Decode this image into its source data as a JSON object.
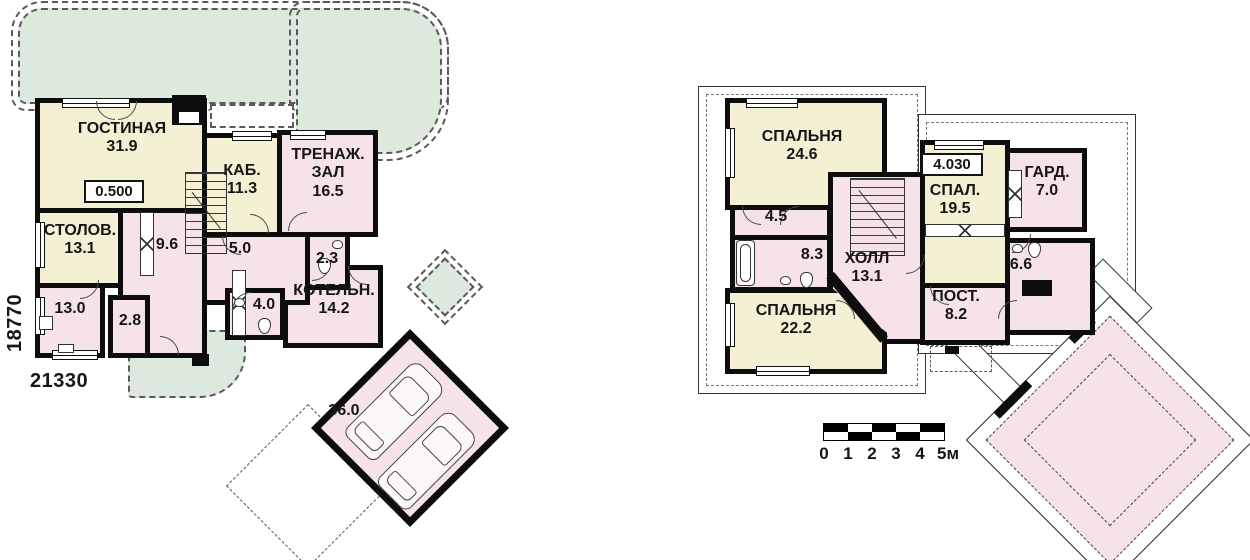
{
  "document": {
    "type": "house floor plans",
    "language": "ru"
  },
  "colors": {
    "room_yellow": "#F4F0D3",
    "room_pink": "#F5E3E9",
    "terrace_green": "#DEE9DE",
    "wall": "#0D0D0D"
  },
  "floor1": {
    "elevation": "0.500",
    "dim_width": "21330",
    "dim_height": "18770",
    "rooms": [
      {
        "name": "ГОСТИНАЯ",
        "area": "31.9"
      },
      {
        "name": "СТОЛОВ.",
        "area": "13.1"
      },
      {
        "name": "",
        "area": "9.6"
      },
      {
        "name": "КАБ.",
        "area": "11.3"
      },
      {
        "name": "ТРЕНАЖ. ЗАЛ",
        "area": "16.5"
      },
      {
        "name": "",
        "area": "5.0"
      },
      {
        "name": "",
        "area": "2.3"
      },
      {
        "name": "",
        "area": "13.0"
      },
      {
        "name": "",
        "area": "2.8"
      },
      {
        "name": "",
        "area": "4.0"
      },
      {
        "name": "КОТЕЛЬН.",
        "area": "14.2"
      },
      {
        "name": "",
        "area": "36.0"
      }
    ]
  },
  "floor2": {
    "elevation": "4.030",
    "rooms": [
      {
        "name": "СПАЛЬНЯ",
        "area": "24.6"
      },
      {
        "name": "",
        "area": "4.5"
      },
      {
        "name": "",
        "area": "8.3"
      },
      {
        "name": "ХОЛЛ",
        "area": "13.1"
      },
      {
        "name": "СПАЛЬНЯ",
        "area": "22.2"
      },
      {
        "name": "СПАЛ.",
        "area": "19.5"
      },
      {
        "name": "ГАРД.",
        "area": "7.0"
      },
      {
        "name": "",
        "area": "6.6"
      },
      {
        "name": "ПОСТ.",
        "area": "8.2"
      }
    ]
  },
  "scale_bar": {
    "unit_labels": [
      "0",
      "1",
      "2",
      "3",
      "4",
      "5м"
    ]
  }
}
